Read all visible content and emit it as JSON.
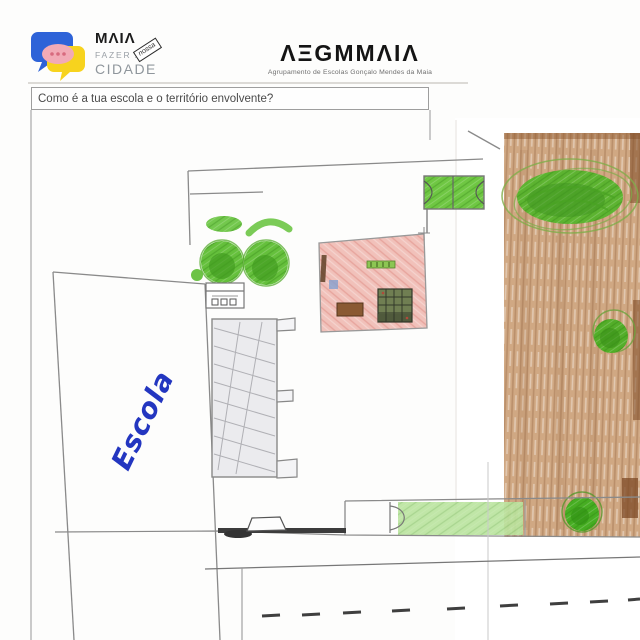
{
  "scan": {
    "header": {
      "maia": {
        "wordmark": "MΛIΛ",
        "tagline_top": "FAZER A",
        "stamp": "nossa",
        "tagline_bottom": "CIDADE"
      },
      "aegmmaia": {
        "wordmark": "ΛΞGMMΛIΛ",
        "subtitle": "Agrupamento de Escolas Gonçalo Mendes da Maia"
      }
    },
    "question": "Como é a tua escola e o território envolvente?",
    "drawing": {
      "school_label": "Escola"
    },
    "colors": {
      "marker_blue": "#2336c0",
      "pencil_gray": "#8a8a8a",
      "dark_line": "#3c3c3c",
      "crayon_green": "#5dbd32",
      "crayon_dark_green": "#3f9a1d",
      "crayon_light_green": "#b9e39d",
      "crayon_pink": "#f1c1ba",
      "crayon_brown": "#c99c72",
      "crayon_dark_brown": "#7d4a26",
      "logo_blue": "#2e63d8",
      "logo_yellow": "#f7d31e",
      "logo_pink": "#f2aab6"
    }
  }
}
